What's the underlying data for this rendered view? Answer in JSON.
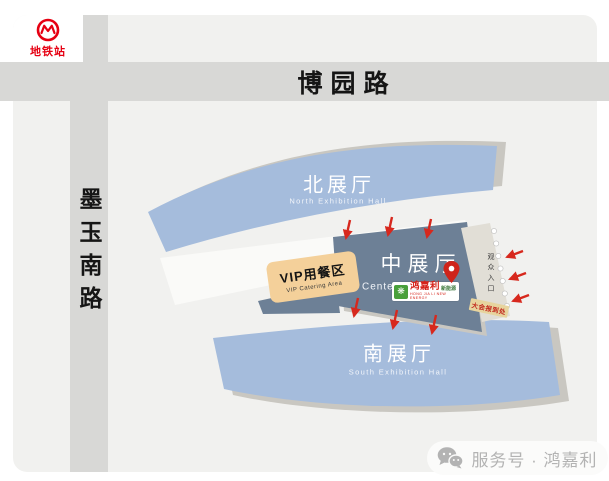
{
  "metro": {
    "station": "地铁站"
  },
  "roads": {
    "top_road": "博园路",
    "left_road": "墨玉南路"
  },
  "halls": {
    "north": {
      "title": "北展厅",
      "subtitle": "North Exhibition Hall"
    },
    "center": {
      "title": "中展厅",
      "subtitle": "Center"
    },
    "south": {
      "title": "南展厅",
      "subtitle": "South Exhibition Hall"
    }
  },
  "vip": {
    "title": "VIP用餐区",
    "subtitle": "VIP Catering Area"
  },
  "entrance": {
    "gate_text": "观众入口",
    "registration": "大会报到处"
  },
  "brand": {
    "name_cn": "鸿嘉利",
    "name_suffix": "新能源",
    "name_en": "HONG JIA LI NEW ENERGY",
    "mark": "❋"
  },
  "footer": {
    "label": "服务号 · 鸿嘉利"
  },
  "colors": {
    "hall_light": "#a5bcdc",
    "hall_dark": "#6d8096",
    "shadow": "#c9c7c1",
    "vip": "#f4d09a",
    "road": "#d8d8d6",
    "card_bg": "#f1f1ef",
    "metro_red": "#e60012",
    "arrow_red": "#d7281d",
    "strip": "#e1ded6"
  }
}
